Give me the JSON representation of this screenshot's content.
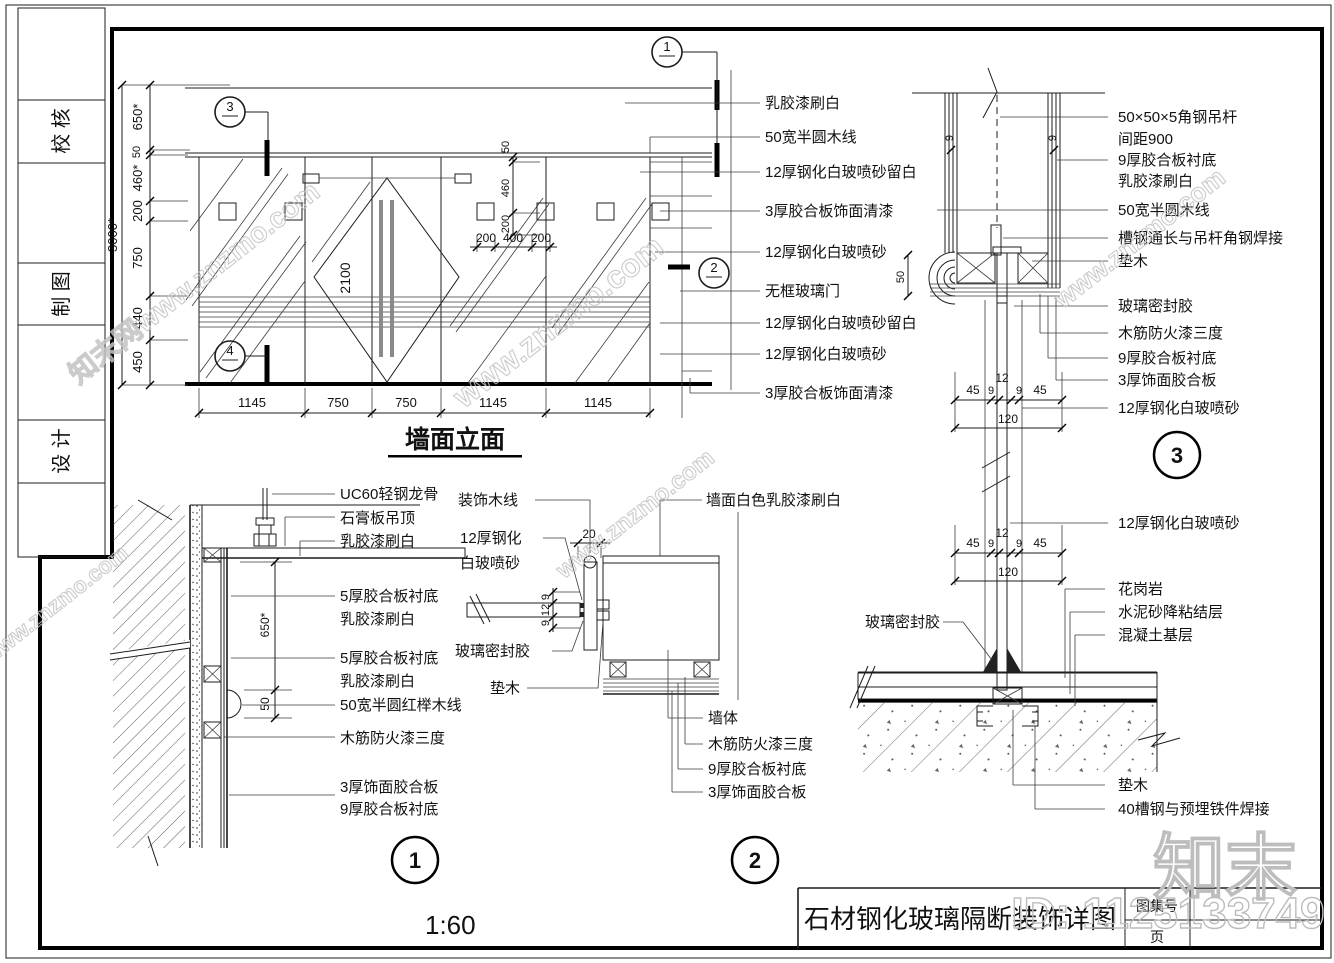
{
  "sidebar": {
    "box1": "校 核",
    "box2": "制 图",
    "box3": "设 计"
  },
  "scale_note": "1:60",
  "titleblock": {
    "title": "石材钢化玻璃隔断装饰详图",
    "atlas": "图集号",
    "page": "页"
  },
  "watermarks": {
    "site": "www.znzmo.com",
    "site_full": "知末网www.znzmo.com",
    "brand": "知末",
    "id": "ID: 1125133749"
  },
  "elevation": {
    "name": "墙面立面",
    "labels": [
      "乳胶漆刷白",
      "50宽半圆木线",
      "12厚钢化白玻喷砂留白",
      "3厚胶合板饰面清漆",
      "12厚钢化白玻喷砂",
      "无框玻璃门",
      "12厚钢化白玻喷砂留白",
      "12厚钢化白玻喷砂",
      "3厚胶合板饰面清漆"
    ],
    "dims": {
      "bottom": [
        "1145",
        "750",
        "750",
        "1145",
        "1145"
      ],
      "left": [
        "650*",
        "50",
        "460*",
        "200",
        "750",
        "440",
        "450"
      ],
      "overall": "3000*",
      "top": [
        "200",
        "400",
        "200"
      ],
      "right": [
        "50",
        "460",
        "200"
      ],
      "door": "2100"
    },
    "callouts": {
      "c1": "1",
      "c2": "2",
      "c3": "3",
      "c4": "4"
    }
  },
  "detail1": {
    "num": "1",
    "labels": [
      "UC60轻钢龙骨",
      "石膏板吊顶",
      "乳胶漆刷白",
      "5厚胶合板衬底",
      "乳胶漆刷白",
      "5厚胶合板衬底",
      "乳胶漆刷白",
      "50宽半圆红榉木线",
      "木筋防火漆三度",
      "3厚饰面胶合板",
      "9厚胶合板衬底"
    ],
    "dims": {
      "a": "650*",
      "b": "50"
    }
  },
  "detail2": {
    "num": "2",
    "left_labels": [
      "装饰木线",
      "12厚钢化",
      "白玻喷砂",
      "玻璃密封胶",
      "垫木"
    ],
    "right_labels": [
      "墙面白色乳胶漆刷白",
      "墙体",
      "木筋防火漆三度",
      "9厚胶合板衬底",
      "3厚饰面胶合板"
    ],
    "dims": {
      "w": "20",
      "g1": "9",
      "t": "12",
      "g2": "9"
    }
  },
  "detail3": {
    "num": "3",
    "top_labels": [
      "50×50×5角钢吊杆",
      "间距900",
      "9厚胶合板衬底",
      "乳胶漆刷白",
      "50宽半圆木线",
      "槽钢通长与吊杆角钢焊接",
      "垫木",
      "玻璃密封胶",
      "木筋防火漆三度",
      "9厚胶合板衬底",
      "3厚饰面胶合板",
      "12厚钢化白玻喷砂"
    ],
    "mid_label": "12厚钢化白玻喷砂",
    "floor_labels": [
      "花岗岩",
      "水泥砂降粘结层",
      "混凝土基层",
      "垫木",
      "40槽钢与预埋铁件焊接"
    ],
    "seal_label": "玻璃密封胶",
    "dims": {
      "nine": "9",
      "fifty": "50",
      "d45": "45",
      "d9": "9",
      "d12": "12",
      "d120": "120"
    }
  }
}
